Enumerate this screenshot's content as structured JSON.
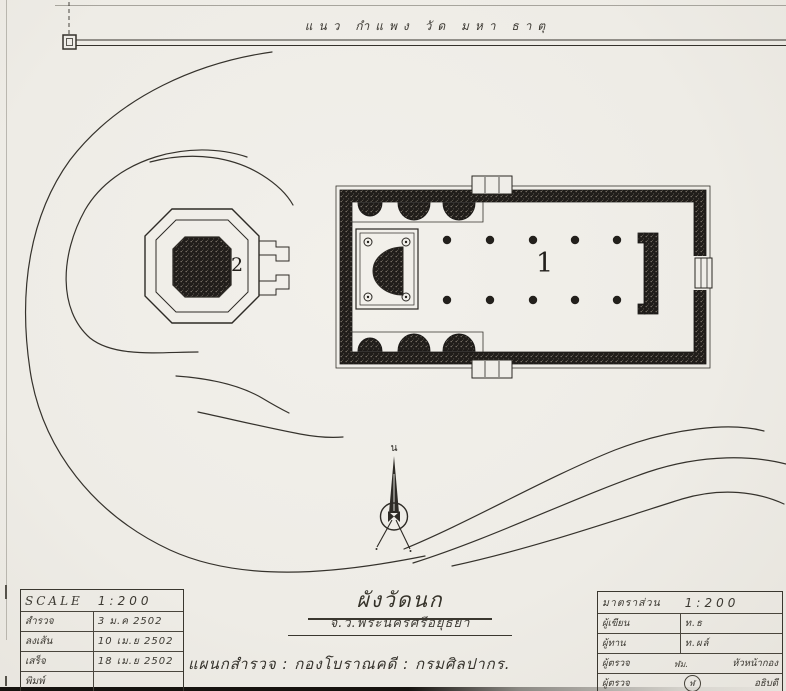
{
  "colors": {
    "paper": "#efede8",
    "ink": "#35322c",
    "wall_dark": "#201d1a"
  },
  "site": {
    "wall_label": "แนว กำแพง วัด มหา ธาตุ",
    "building1_label": "1",
    "building2_label": "2",
    "north_label": "น"
  },
  "title_block": {
    "title": "ผังวัดนก",
    "subtitle": "จ.ว.พระนครศรีอยุธยา",
    "department": "แผนกสำรวจ : กองโบราณคดี : กรมศิลปากร."
  },
  "scale_table": {
    "header": {
      "label": "SCALE",
      "value": "1:200"
    },
    "rows": [
      {
        "label": "สำรวจ",
        "value": "3 ม.ค 2502"
      },
      {
        "label": "ลงเส้น",
        "value": "10 เม.ย 2502"
      },
      {
        "label": "เสร็จ",
        "value": "18 เม.ย 2502"
      },
      {
        "label": "พิมพ์",
        "value": ""
      }
    ]
  },
  "approval_table": {
    "header": {
      "label": "มาตราส่วน",
      "value": "1:200"
    },
    "rows": [
      {
        "label": "ผู้เขียน",
        "sign": "",
        "value": "ท.ธ"
      },
      {
        "label": "ผู้ทาน",
        "sign": "",
        "value": "ท.ผล์"
      },
      {
        "label": "ผู้ตรวจ",
        "sign": "ฬม.",
        "value": "หัวหน้ากอง"
      },
      {
        "label": "ผู้ตรวจ",
        "sign": "ฬ",
        "value": "อธิบดี"
      }
    ]
  }
}
